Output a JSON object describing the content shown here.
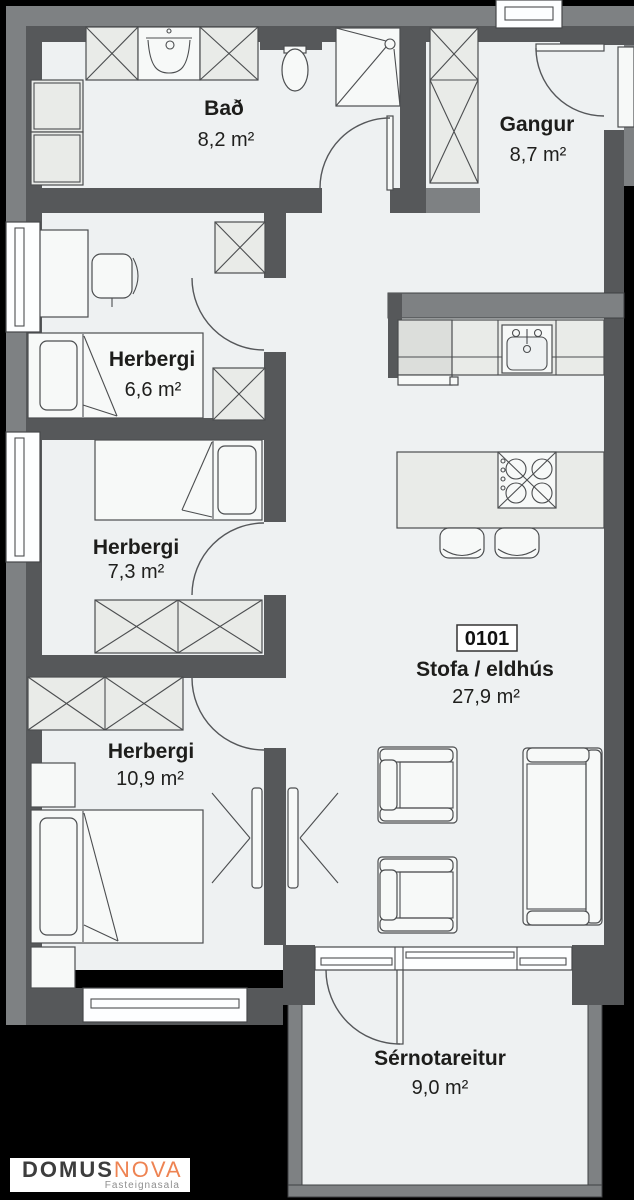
{
  "unit": {
    "number": "0101"
  },
  "rooms": [
    {
      "id": "bad",
      "name": "Bað",
      "area": "8,2 m²"
    },
    {
      "id": "gangur",
      "name": "Gangur",
      "area": "8,7 m²"
    },
    {
      "id": "herbergi-1",
      "name": "Herbergi",
      "area": "6,6 m²"
    },
    {
      "id": "herbergi-2",
      "name": "Herbergi",
      "area": "7,3 m²"
    },
    {
      "id": "herbergi-3",
      "name": "Herbergi",
      "area": "10,9 m²"
    },
    {
      "id": "stofa-eldhus",
      "name": "Stofa / eldhús",
      "area": "27,9 m²"
    },
    {
      "id": "sernotareitur",
      "name": "Sérnotareitur",
      "area": "9,0 m²"
    }
  ],
  "logo": {
    "domus": "DOMUS",
    "nova": "NOVA",
    "tagline": "Fasteignasala"
  },
  "colors": {
    "background": "#000000",
    "wall_dark": "#56585a",
    "wall_gray": "#7e8183",
    "floor": "#eef1f2",
    "furniture_fill": "#e9ebe8",
    "outline": "#4c4e50",
    "logo_orange": "#ee8352",
    "logo_dark": "#3d3d3d",
    "label_text": "#1d1d1b"
  }
}
